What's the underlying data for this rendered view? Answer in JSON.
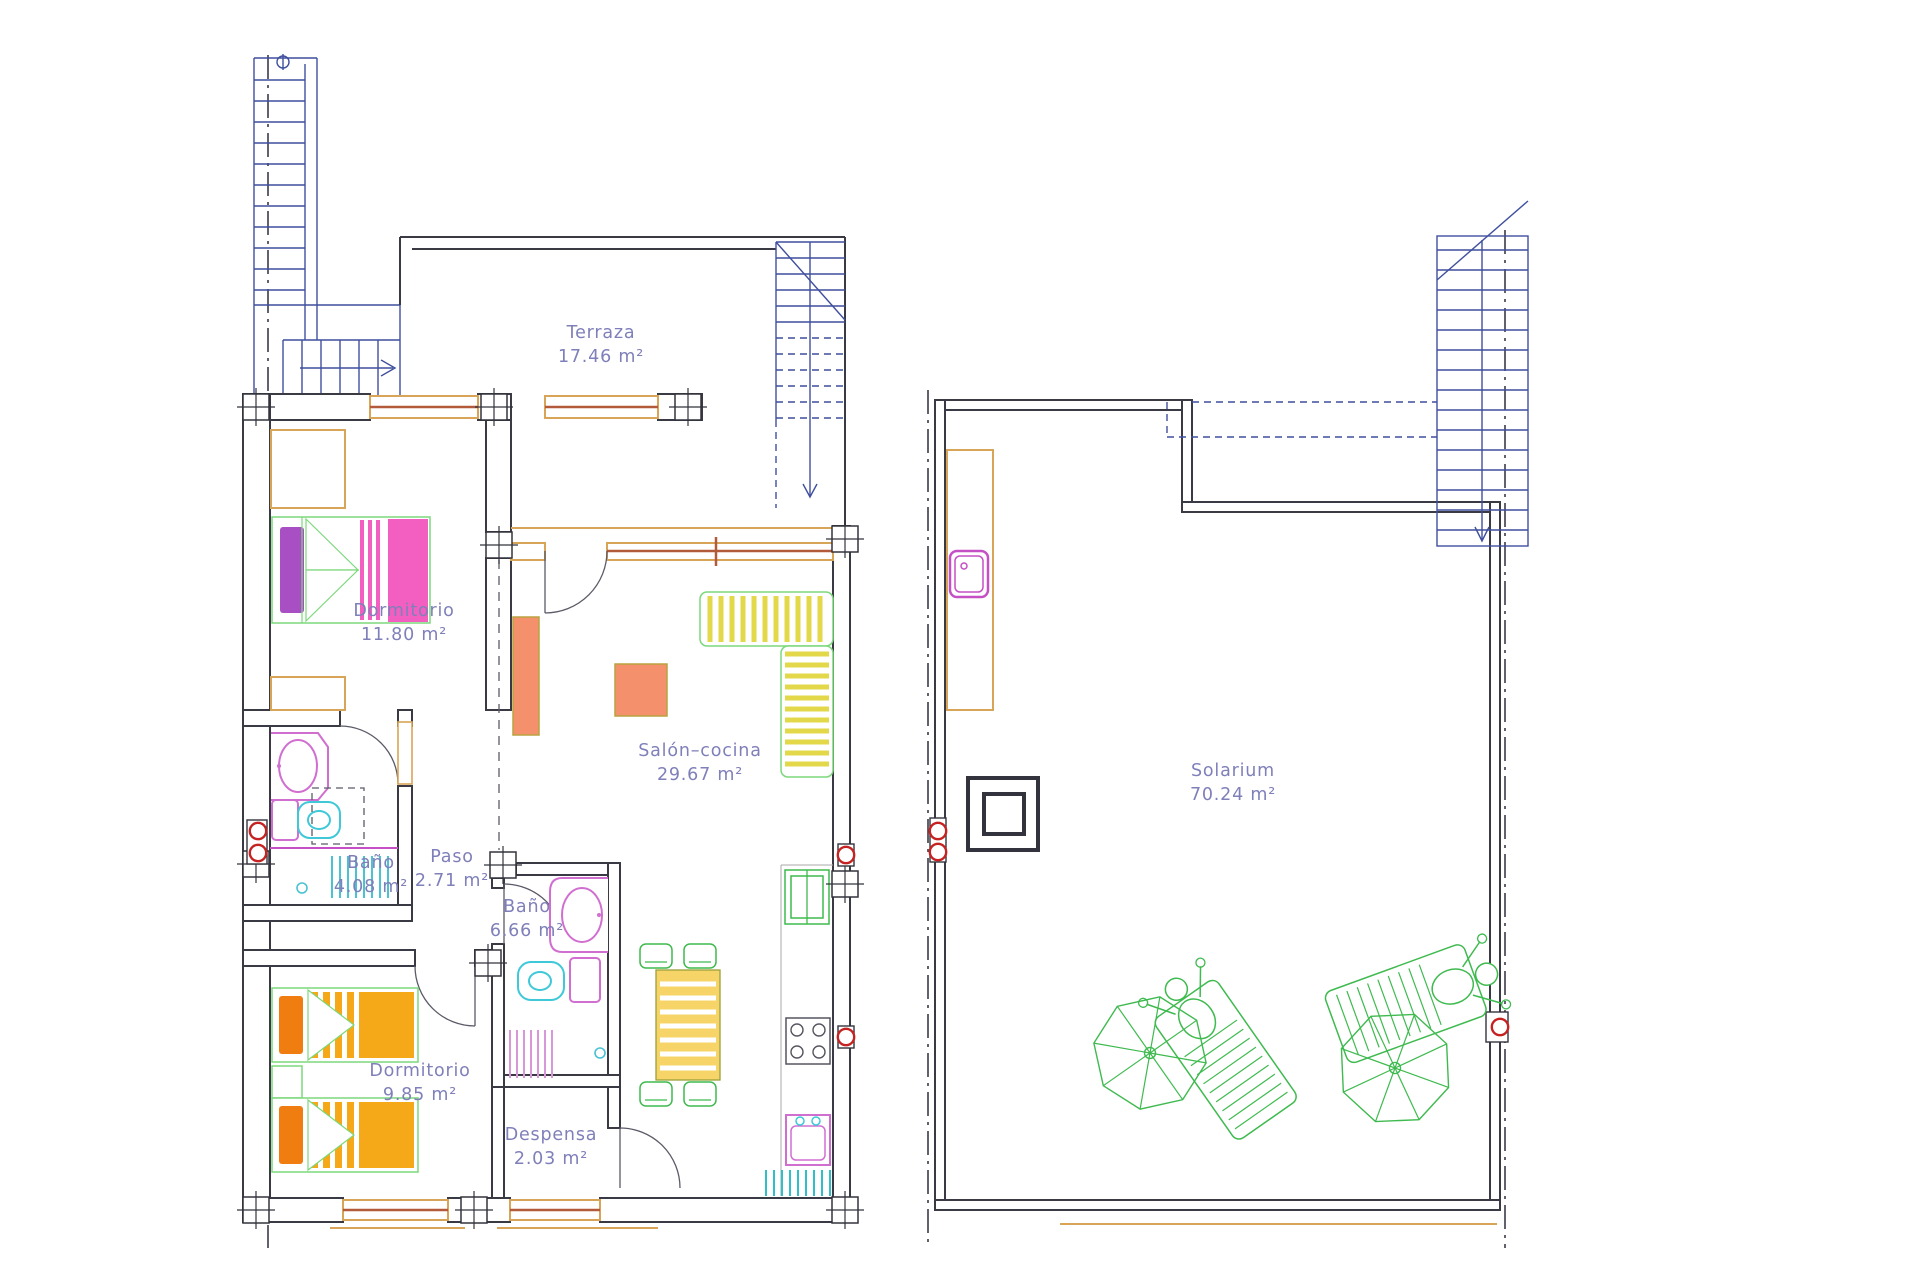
{
  "rooms": {
    "terraza": {
      "name": "Terraza",
      "area": "17.46 m²"
    },
    "dormitorio1": {
      "name": "Dormitorio",
      "area": "11.80 m²"
    },
    "salon_cocina": {
      "name": "Salón–cocina",
      "area": "29.67 m²"
    },
    "bano1": {
      "name": "Baño",
      "area": "4.08 m²"
    },
    "paso": {
      "name": "Paso",
      "area": "2.71 m²"
    },
    "bano2": {
      "name": "Baño",
      "area": "6.66 m²"
    },
    "dormitorio2": {
      "name": "Dormitorio",
      "area": "9.85 m²"
    },
    "despensa": {
      "name": "Despensa",
      "area": "2.03 m²"
    },
    "solarium": {
      "name": "Solarium",
      "area": "70.24 m²"
    }
  },
  "palette": {
    "wall": "#3a3a44",
    "stairs_blue": "#3f4f9e",
    "label_purple": "#7f7fba",
    "window_frame_tan": "#d8a558",
    "window_core_red": "#b25a3a",
    "furniture_salmon": "#f4906c",
    "sofa_yellow": "#e3d84a",
    "table_yellow": "#f6d468",
    "outline_green": "#7bd87b",
    "outdoor_green": "#3fba4f",
    "bed_pink": "#f25fc0",
    "pillow_purple": "#a94fc4",
    "bed_orange": "#f5a818",
    "pillow_orange": "#ef7d10",
    "fixture_pink": "#d06fd0",
    "fixture_cyan": "#3fc8d8",
    "accent_red": "#c52222",
    "kitchen_teal": "#2fbfc9"
  }
}
